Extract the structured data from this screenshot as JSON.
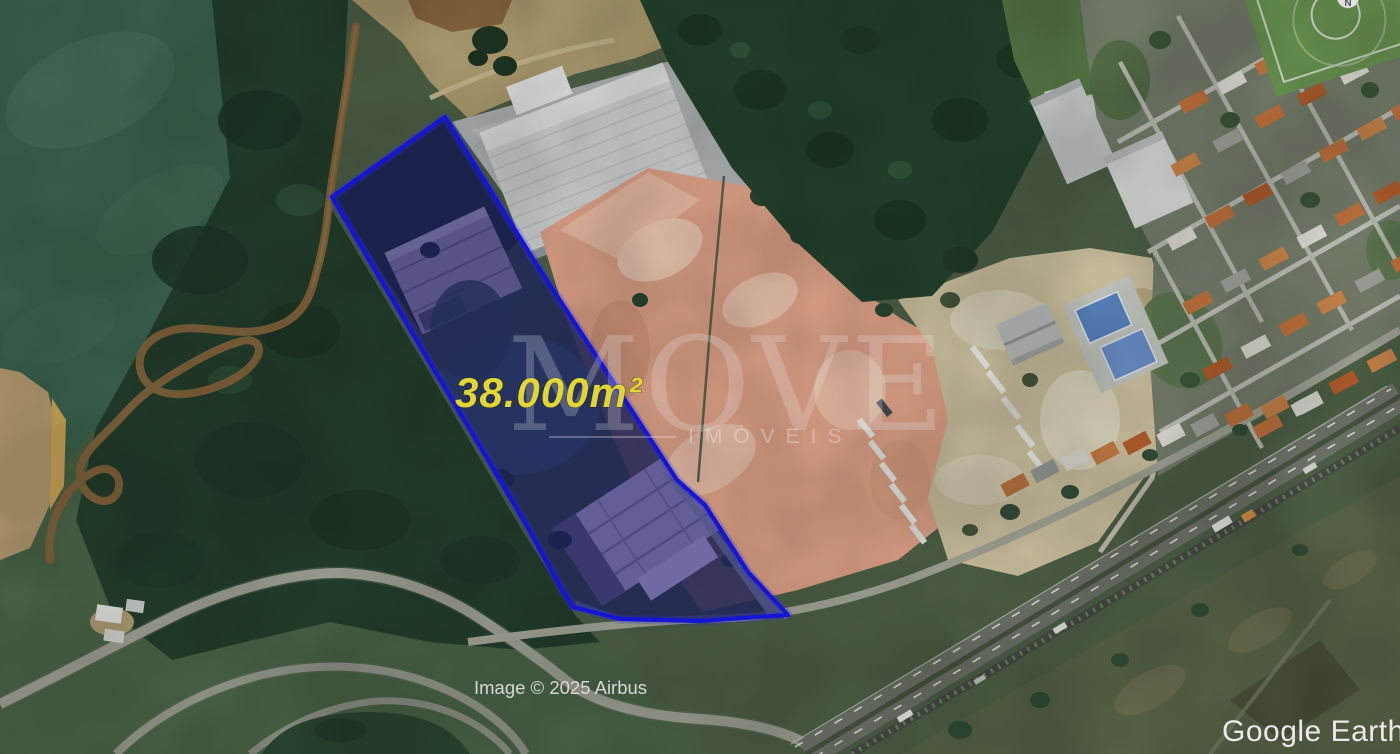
{
  "map_overlay": {
    "area_label": "38.000m²",
    "outline_color": "#1717e8",
    "label_color": "#f2e93c"
  },
  "watermark": {
    "title": "MOVE",
    "subtitle": "IMÓVEIS"
  },
  "attribution": {
    "imagery_credit": "Image © 2025 Airbus"
  },
  "branding": {
    "logo_text": "Google Earth"
  },
  "compass": {
    "north_label": "N"
  }
}
